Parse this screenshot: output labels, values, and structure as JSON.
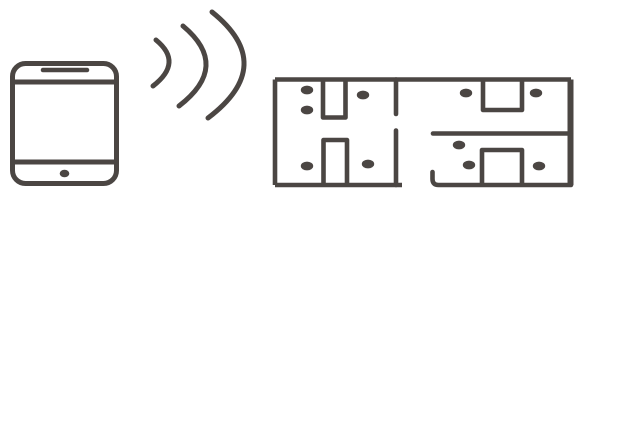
{
  "colors": {
    "ink": "#4b4643",
    "background": "#ffffff"
  },
  "illustration": {
    "phone": {
      "icon": "smartphone-icon"
    },
    "signal": {
      "icon": "wireless-signal-icon",
      "arc_count": 3
    },
    "floor_plan": {
      "icon": "floor-plan-icon",
      "room_count": 4,
      "dot_count": 10,
      "device_dots": [
        {
          "x": 307,
          "y": 90
        },
        {
          "x": 307,
          "y": 110
        },
        {
          "x": 363,
          "y": 95
        },
        {
          "x": 307,
          "y": 166
        },
        {
          "x": 368,
          "y": 164
        },
        {
          "x": 466,
          "y": 93
        },
        {
          "x": 536,
          "y": 93
        },
        {
          "x": 459,
          "y": 145
        },
        {
          "x": 469,
          "y": 165
        },
        {
          "x": 539,
          "y": 166
        }
      ],
      "dot_rx": 6.2,
      "dot_ry": 4.4
    }
  }
}
